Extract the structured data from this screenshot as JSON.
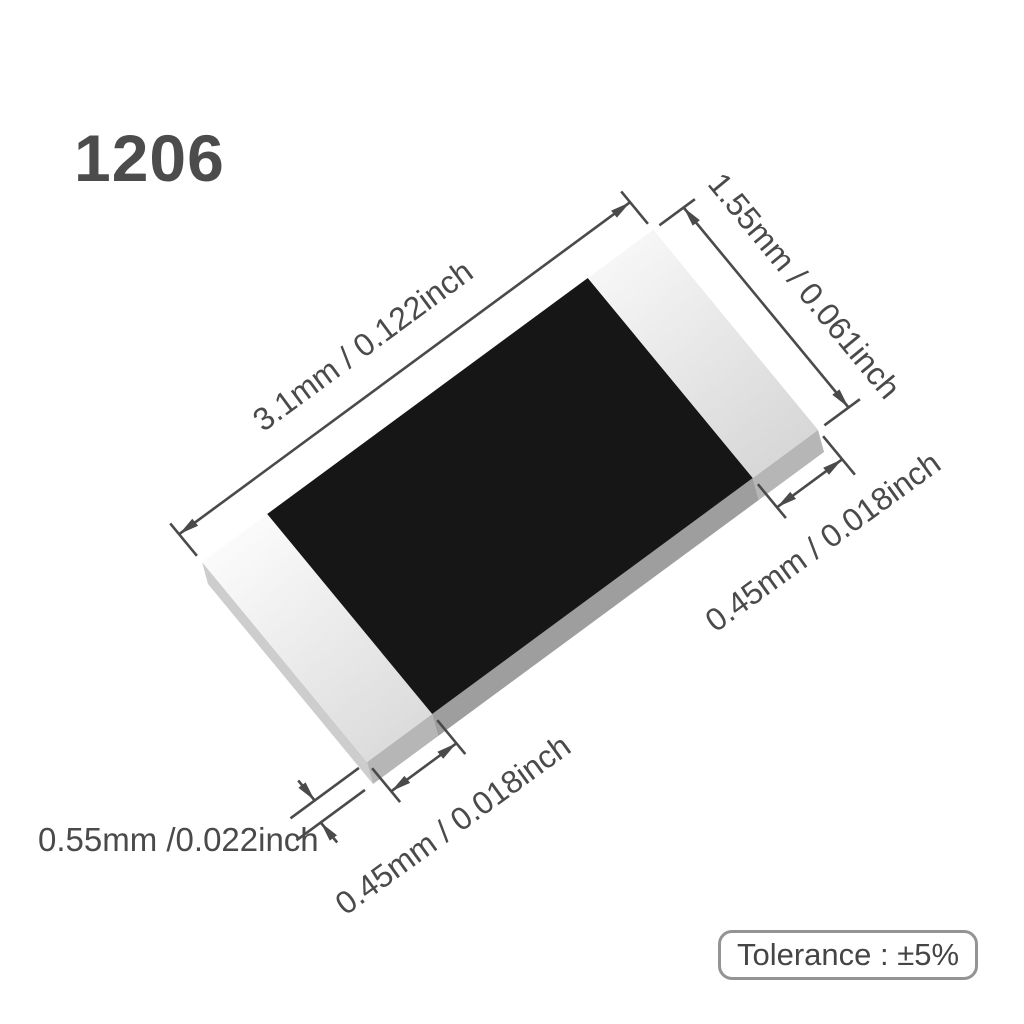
{
  "title": "1206",
  "dimensions": {
    "length": {
      "label": "3.1mm / 0.122inch"
    },
    "width": {
      "label": "1.55mm / 0.061inch"
    },
    "terminal_right": {
      "label": "0.45mm / 0.018inch"
    },
    "terminal_left": {
      "label": "0.45mm / 0.018inch"
    },
    "thickness": {
      "label": "0.55mm /0.022inch"
    }
  },
  "tolerance": {
    "label": "Tolerance : ±5%"
  },
  "colors": {
    "background": "#ffffff",
    "body": "#161616",
    "body_side": "#9e9e9e",
    "terminal_side": "#b6b6b6",
    "end_face": "#cdcdcd",
    "line": "#4a4a4a",
    "text": "#4a4a4a",
    "badge_border": "#949494"
  }
}
